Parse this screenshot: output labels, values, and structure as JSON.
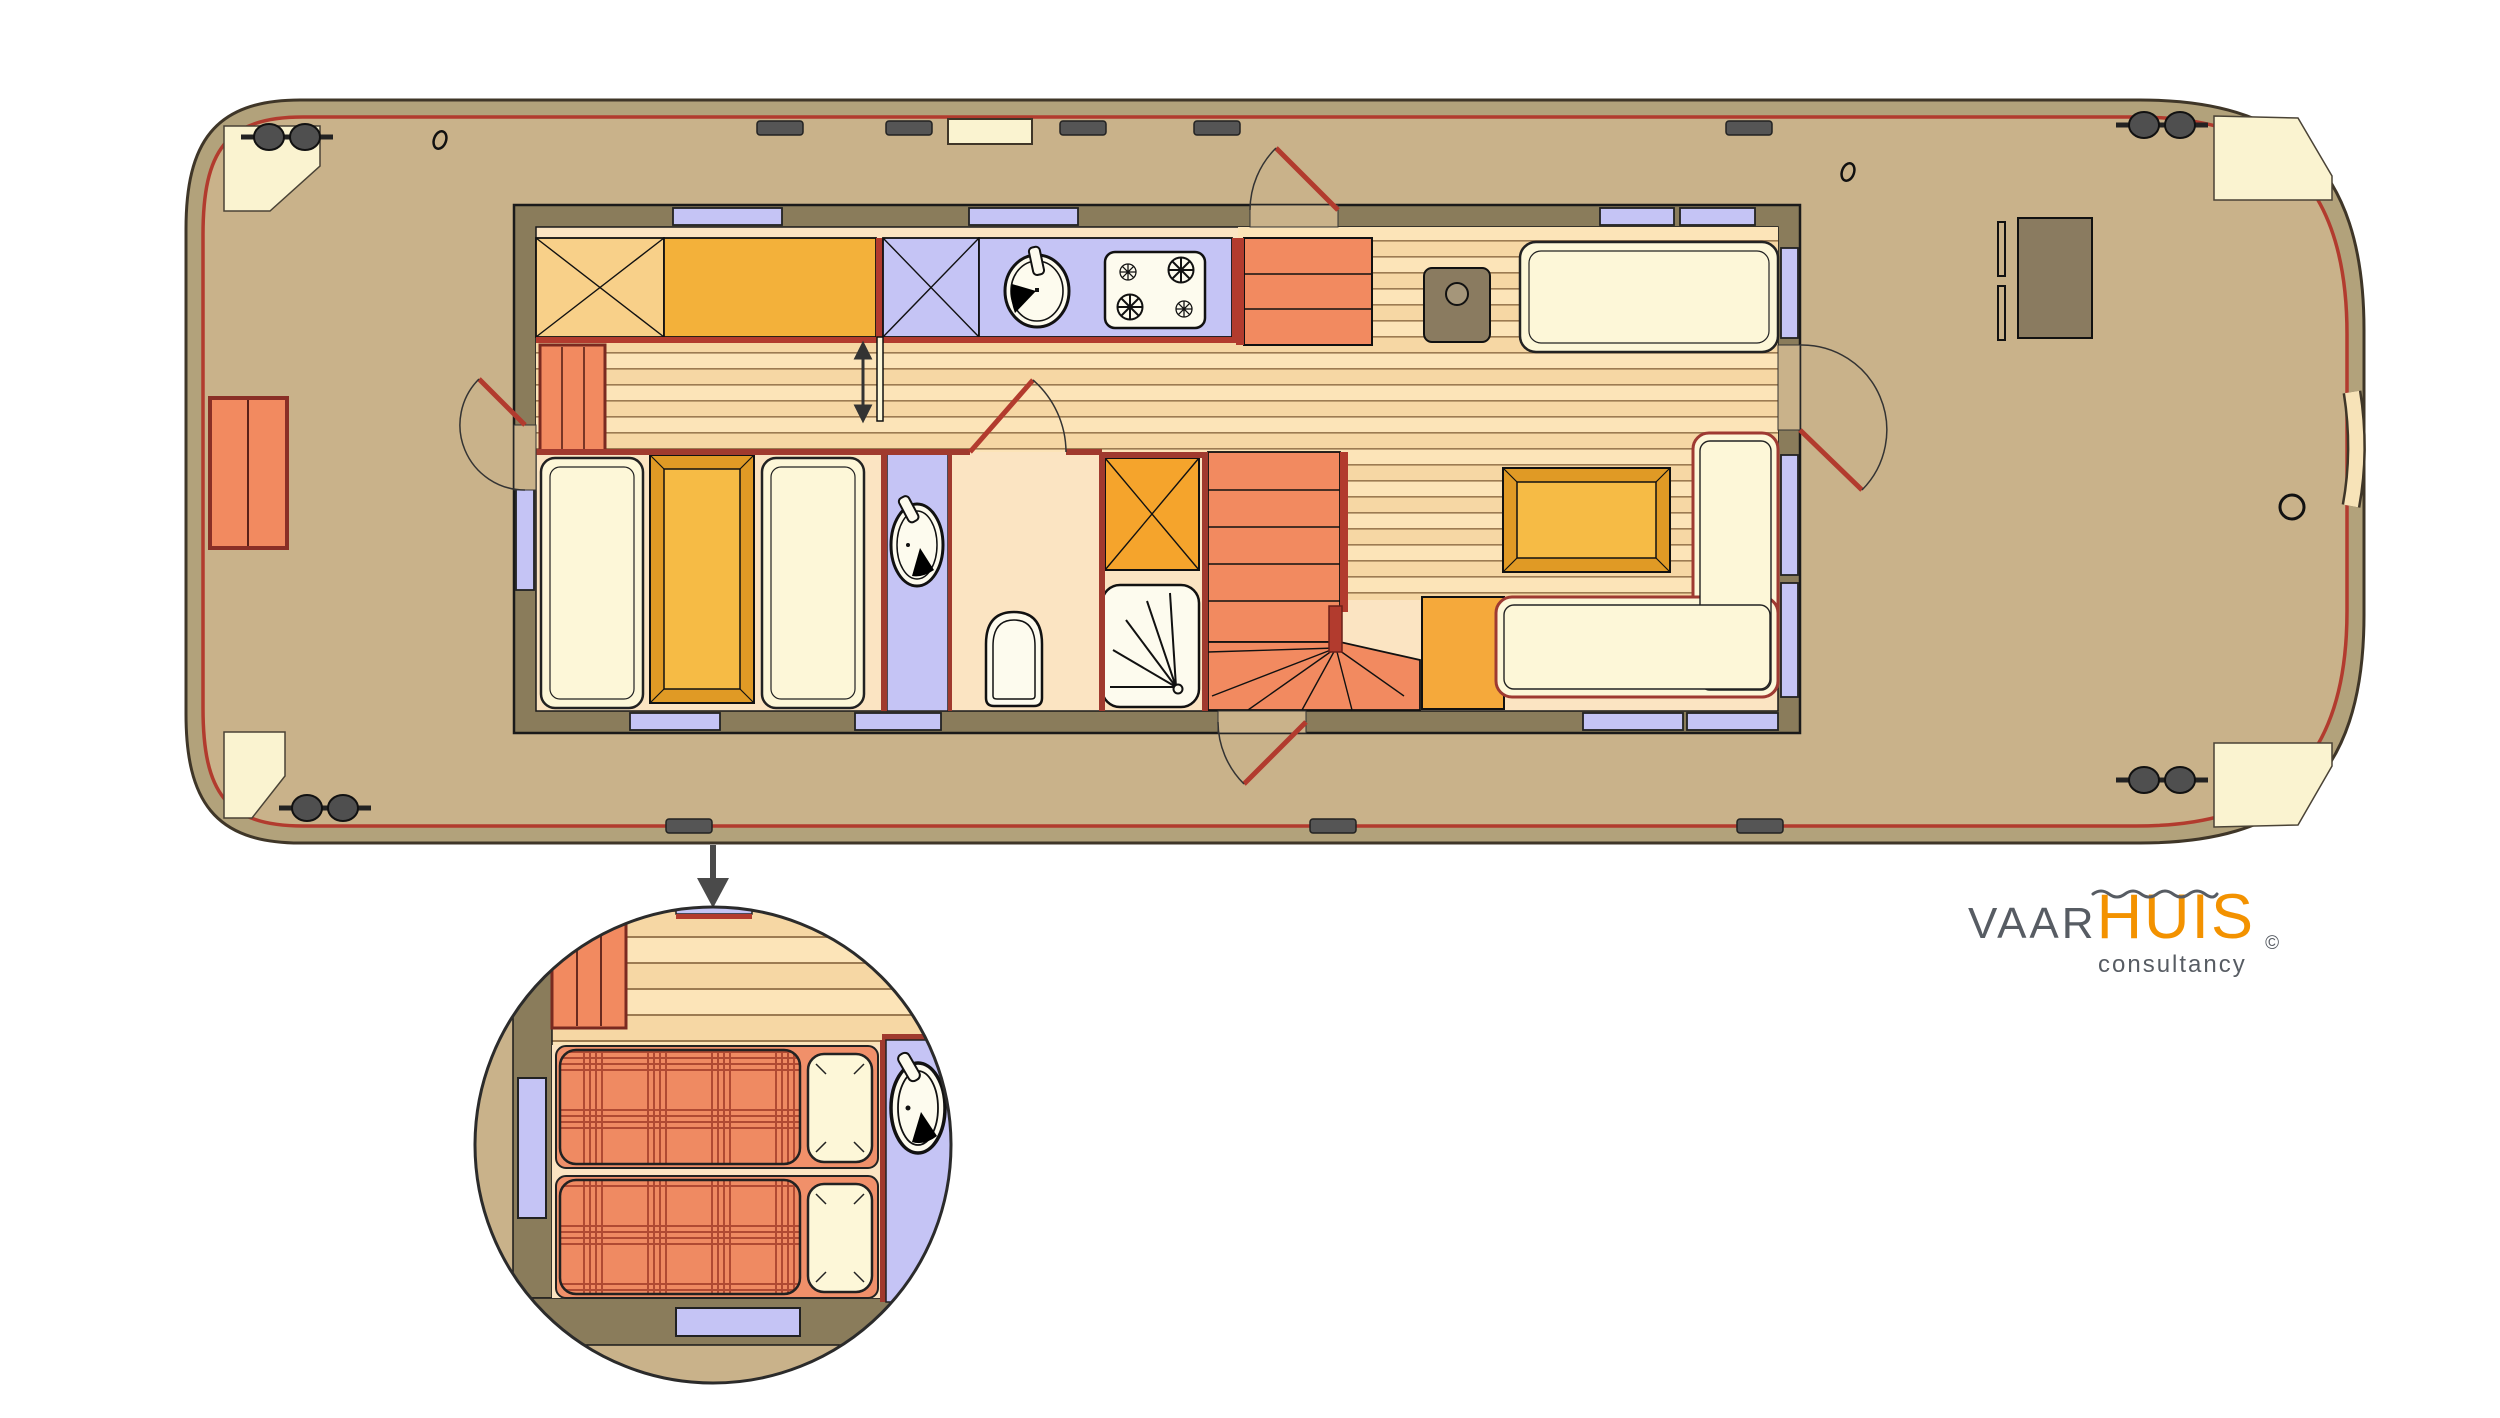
{
  "title": "Houseboat floor plan",
  "logo": {
    "brand_part1": "VAAR",
    "brand_part2": "HUIS",
    "subtitle": "consultancy",
    "copyright_symbol": "©"
  },
  "palette": {
    "page_bg": "#ffffff",
    "deck": "#c9b28a",
    "hull_band": "#b2a27b",
    "hull_outline": "#3f3628",
    "trim_red": "#b23b2e",
    "wall_olive": "#8a7c5b",
    "window": "#c5c4f5",
    "floor_plain": "#fbe4c2",
    "plank_light": "#fce4b8",
    "plank_mid": "#f6d7a4",
    "plank_line": "#9c7b52",
    "cab_light": "#f8d089",
    "cab_orange": "#f3b13a",
    "salmon": "#f28a60",
    "cream": "#fdf7d8",
    "wall_red": "#a03a2e",
    "fixture_white": "#fdfbee",
    "heater": "#8a7b60",
    "plaid_base": "#ef8a62",
    "plaid_line": "#b04a33",
    "table_frame": "#e09a25",
    "table_top": "#f6bb45",
    "logo_orange": "#f39200",
    "logo_gray": "#575c63",
    "cleat": "#4f4f4f",
    "corner_cream": "#faf3d0"
  },
  "fixtures": [
    "bow-deck",
    "stern-deck",
    "galley-counter",
    "sink",
    "gas-hob-4-burner",
    "dinette-berths",
    "dinette-table",
    "wardrobe",
    "washbasin-vanity",
    "toilet",
    "shower",
    "companionway-steps",
    "winding-staircase",
    "solid-fuel-stove",
    "sofa-bench",
    "l-shaped-sofa",
    "coffee-table",
    "helm-console",
    "mooring-cleats",
    "fender-blocks",
    "boarding-gate",
    "mooring-ring",
    "detail-view-twin-beds"
  ]
}
